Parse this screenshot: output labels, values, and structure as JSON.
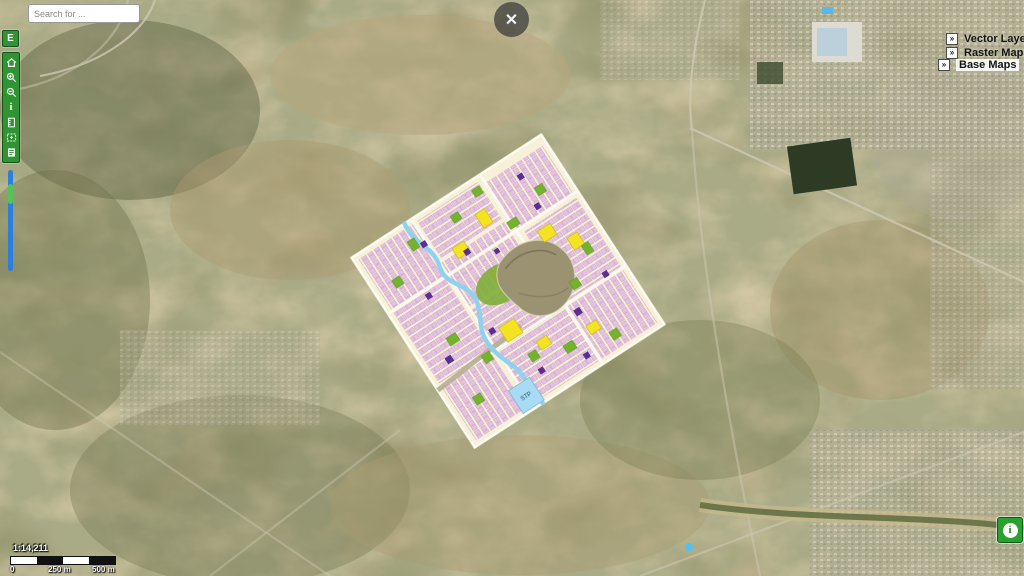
{
  "search": {
    "placeholder": "Search for ..."
  },
  "close_button": {
    "glyph": "✕"
  },
  "toolbar": {
    "e_button_label": "E",
    "icons": [
      "home",
      "zoom-in",
      "zoom-out",
      "info",
      "measure",
      "select-extent",
      "export"
    ]
  },
  "zoom_slider": {
    "thumb_position_percent": 15
  },
  "layers_panel": {
    "expand_glyph": "»",
    "items": [
      {
        "label": "Vector Layers",
        "highlighted": false
      },
      {
        "label": "Raster Maps",
        "highlighted": false
      },
      {
        "label": "Base Maps",
        "highlighted": true
      }
    ]
  },
  "scale": {
    "ratio": "1:14,211",
    "ticks": [
      "0",
      "250 m",
      "500 m"
    ]
  },
  "info_button": {
    "glyph": "i"
  },
  "map": {
    "type": "satellite-basemap-with-masterplan-overlay",
    "overlay": {
      "stp_label": "STP"
    }
  },
  "colors": {
    "toolbar_green": "#2f9431",
    "slider_blue": "#2e7fd9",
    "slider_thumb_green": "#55c25a",
    "plan_cream": "#f6f1d8",
    "plan_pink": "#e7c0e4",
    "plan_yellow": "#f4e320",
    "plan_green": "#74b42c",
    "plan_purple": "#5b2f91",
    "stream_blue": "#8ed2f0",
    "info_green": "#28a22c"
  }
}
